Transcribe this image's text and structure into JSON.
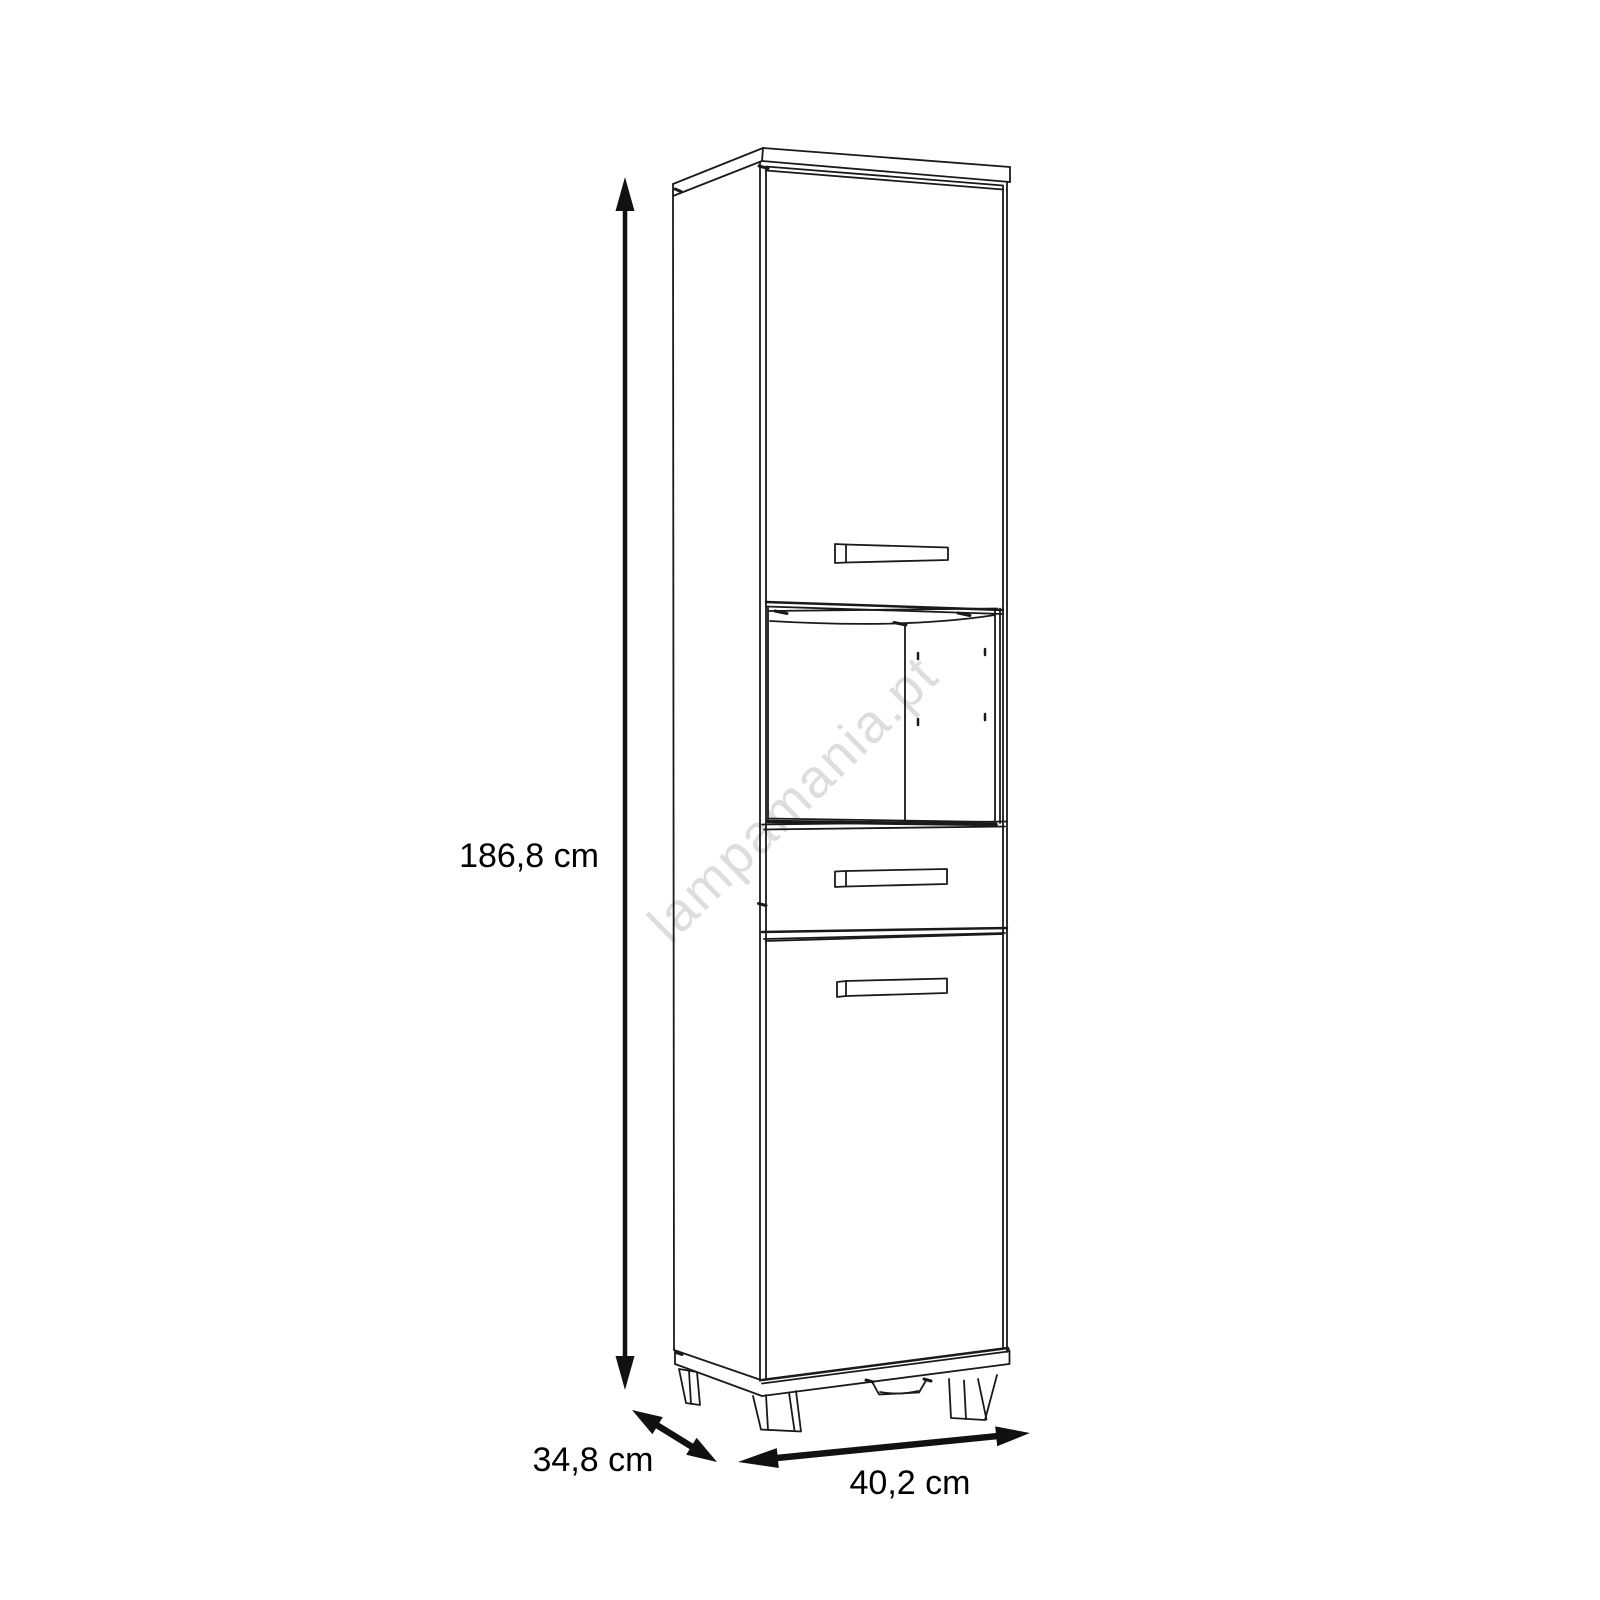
{
  "diagram": {
    "watermark": "lampamania.pt",
    "dimensions": {
      "height": "186,8 cm",
      "depth": "34,8 cm",
      "width": "40,2 cm"
    },
    "colors": {
      "line": "#1a1a1a",
      "arrow": "#111111",
      "label_text": "#000000",
      "watermark": "#c2c2c2",
      "background": "#ffffff"
    }
  }
}
